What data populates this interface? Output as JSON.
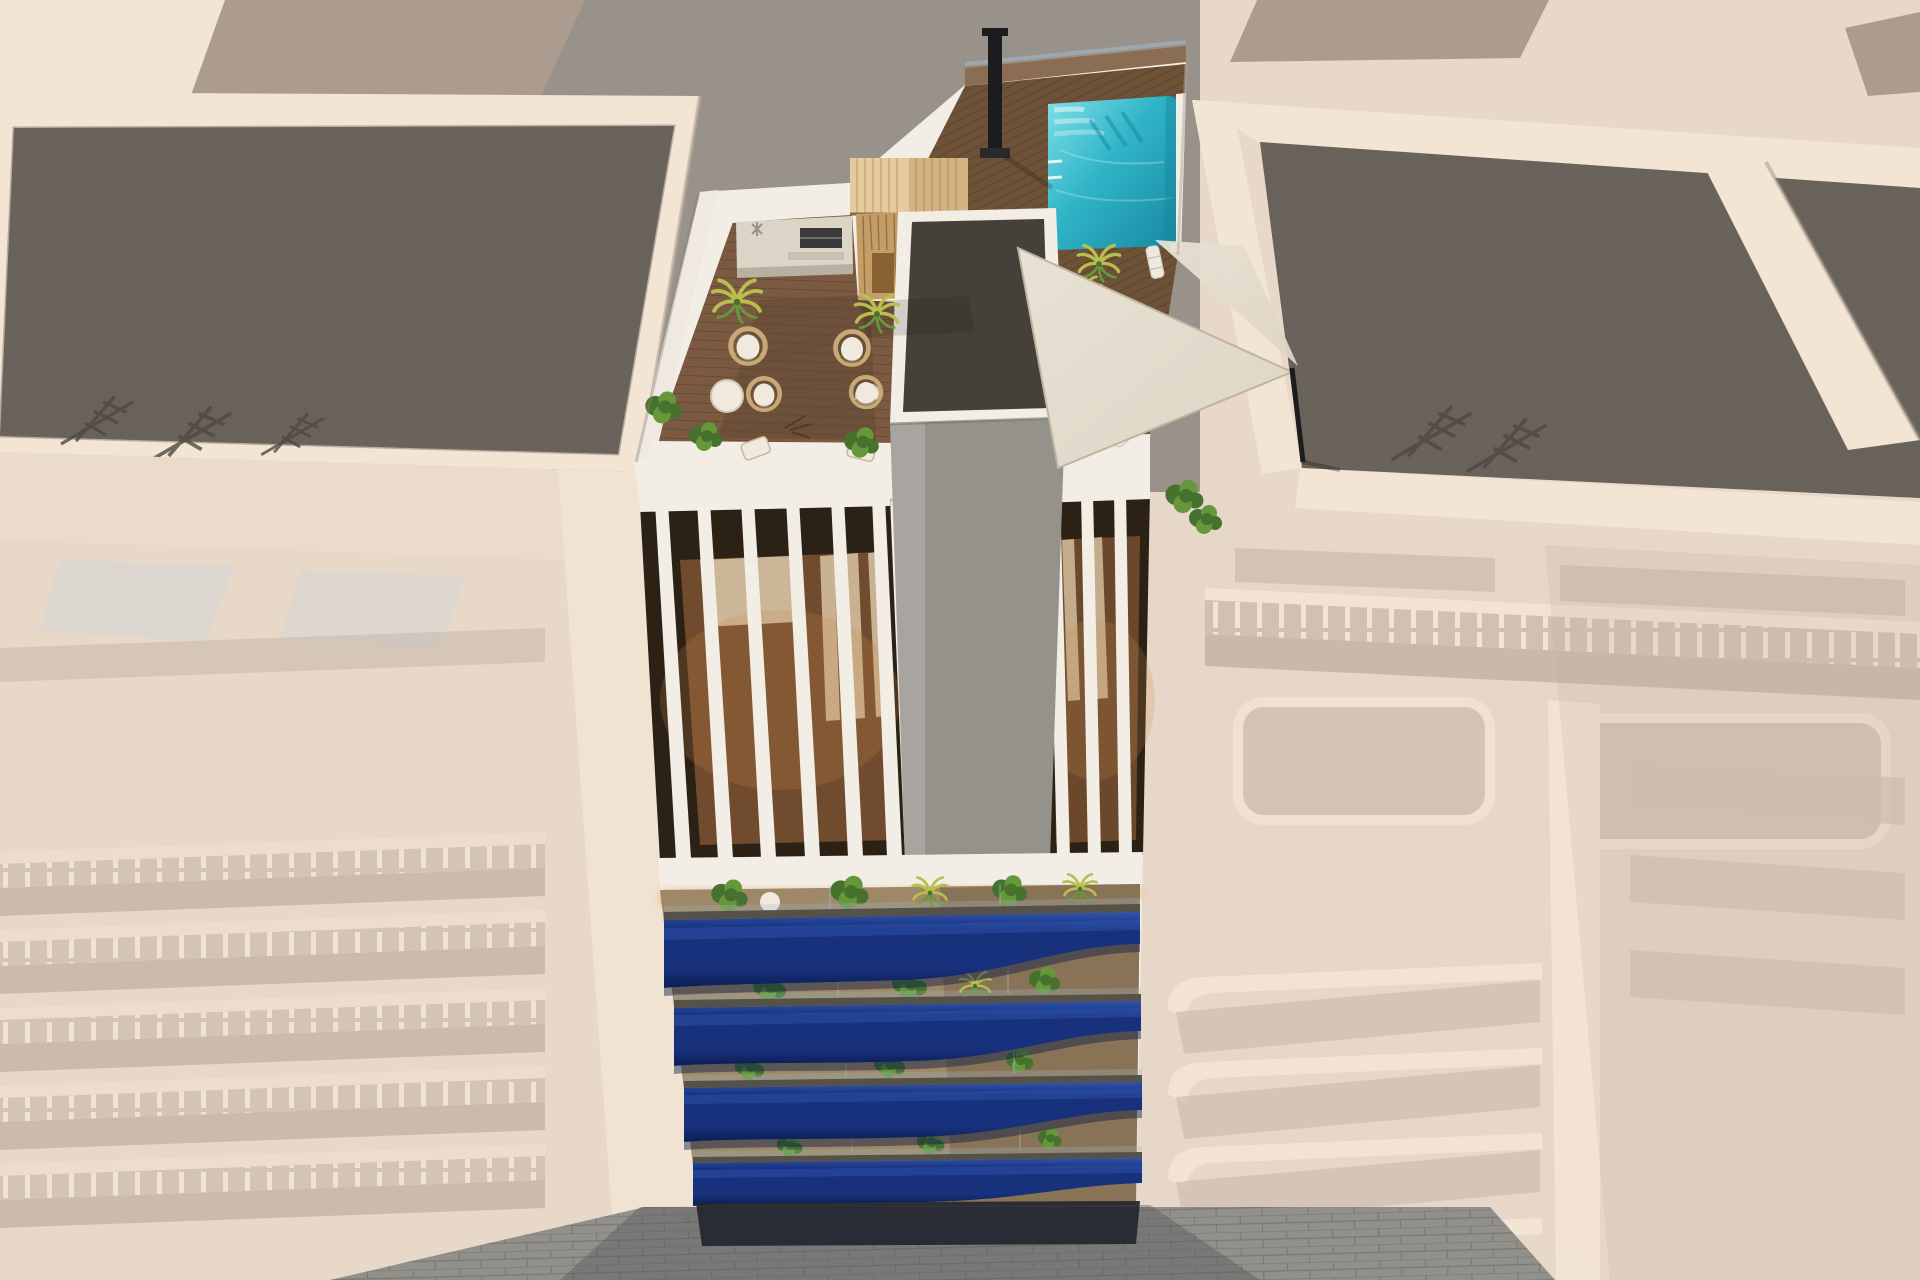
{
  "scene": {
    "type": "3d-architectural-aerial-render",
    "subject": "Aerial render of a residential apartment tower with rooftop pool terrace, wooden deck, pergola, sauna, shade sails and wavy royal-blue balconies, flanked by pale washed-out neighboring buildings and a paved street below",
    "elements": [
      "neighbor-roof-northwest",
      "neighbor-roof-northeast",
      "neighbor-building-west",
      "neighbor-building-east",
      "street-pavement",
      "rooftop-terrace",
      "rooftop-wood-deck",
      "swimming-pool",
      "pool-deck",
      "pool-ladder",
      "pergola",
      "sauna",
      "outdoor-kitchen-counter",
      "bbq-grill",
      "stair-core-block",
      "shade-sails",
      "sail-mast",
      "chimney-pole",
      "sun-loungers",
      "hanging-egg-chairs",
      "coffee-tables",
      "potted-plants",
      "palm-plants",
      "penthouse-pergola-slats",
      "penthouse-bedrooms",
      "led-cornice-strip",
      "wave-balcony-fronts",
      "balcony-planting",
      "glass-railings",
      "granite-balcony-bands",
      "roof-antennas"
    ]
  },
  "colors": {
    "canvas_beige": "#e8d8c9",
    "warm_white": "#f2ede5",
    "parapet_lit": "#f3e5d4",
    "parapet_shade": "#cdbfb1",
    "neighbor_wall": "#e3d3c4",
    "neighbor_recess": "#c4b3a4",
    "neighbor_shadow": "#ab9c8f",
    "neighbor_wash": "#f0dfcf",
    "soffit_blue": "#ccd2d4",
    "gray_wall": "#99928b",
    "gravel_light": "#8b8278",
    "gravel_dark": "#57504a",
    "core_gray": "#95928c",
    "core_gray_light": "#a8a5a0",
    "deck_wood": "#7b5a41",
    "deck_wood_dark": "#5f4531",
    "pool_deck_wood": "#6e5238",
    "tile_brown": "#8a6d52",
    "pergola_wood": "#e5ca9c",
    "pergola_wood_dark": "#d4b380",
    "sauna_wood": "#c49e66",
    "counter_concrete": "#dcd4c6",
    "pool_teal": "#30b4c8",
    "pool_teal_light": "#7ee0e8",
    "pool_teal_dark": "#1788a0",
    "sail": "#ddd4c5",
    "sail_light": "#e9e2d4",
    "sail_shadow": "#bfb4a2",
    "plant_green": "#46722e",
    "plant_green_light": "#67973b",
    "palm_yellow": "#b9bf4e",
    "blue_balcony": "#17317d",
    "blue_balcony_dark": "#0c1d52",
    "blue_balcony_light": "#3054ab",
    "granite": "#6f6a62",
    "balcony_floor": "#9f8867",
    "balcony_floor_shade": "#6f5c44",
    "interior_dark": "#2c2115",
    "interior_wood": "#7c5232",
    "curtain": "#d8c5a3",
    "bed_linen": "#cbb698",
    "led_copper": "#df9a73",
    "led_glow": "#f6c9a2",
    "street_paver": "#91908b",
    "street_joint": "#7b7974",
    "street_shadow": "#55555a",
    "white_furniture": "#efe9de",
    "rattan": "#c7a877",
    "chimney_black": "#1c1c1e",
    "glass_tint": "#9fb6c6",
    "antenna": "#4e4942"
  }
}
